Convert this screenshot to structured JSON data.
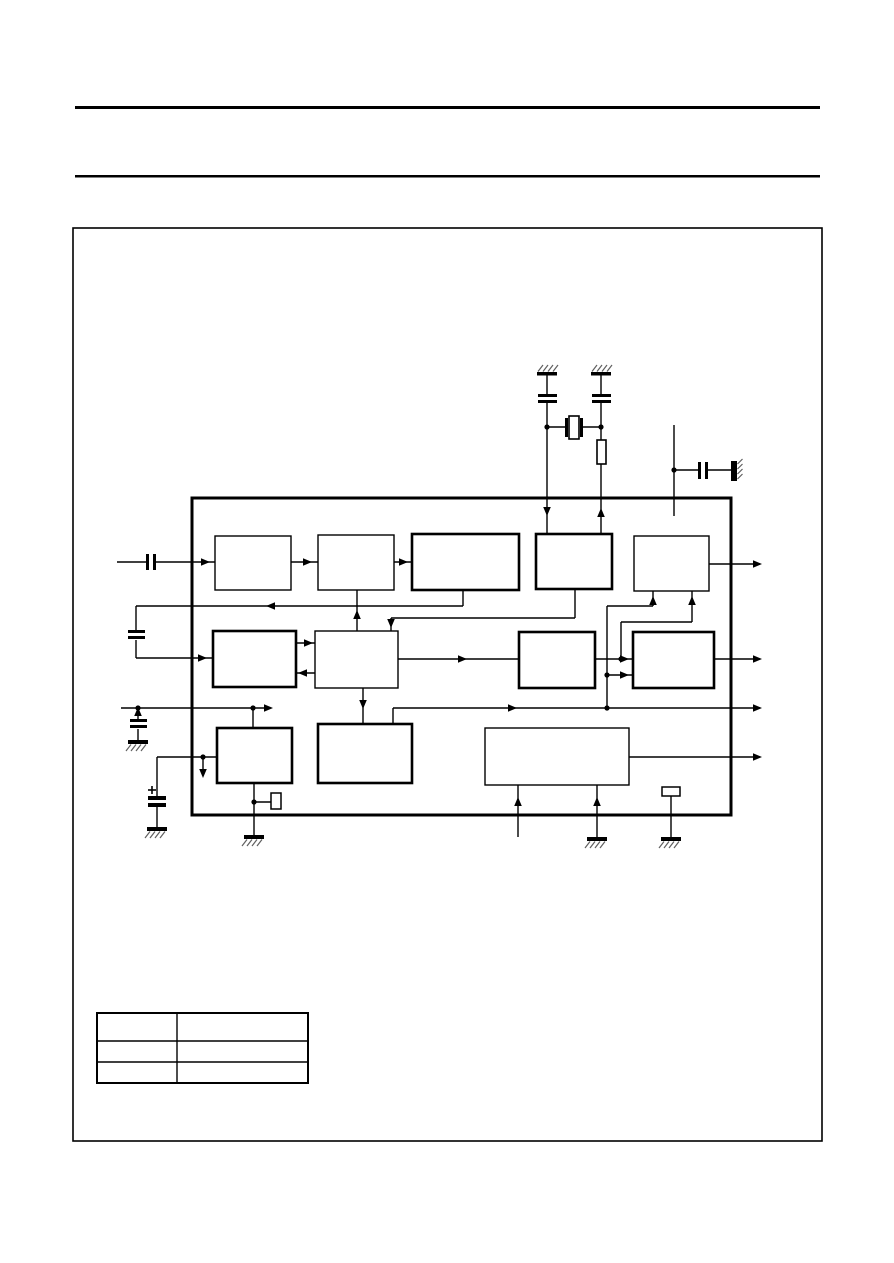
{
  "colors": {
    "ink": "#000000",
    "paper": "#ffffff",
    "hatch": "#606060"
  },
  "header": {
    "rules": [
      {
        "x": 75,
        "y": 106,
        "w": 745,
        "h": 3
      },
      {
        "x": 75,
        "y": 175,
        "w": 745,
        "h": 2.5
      }
    ]
  },
  "figure_frame": {
    "x": 73,
    "y": 228,
    "w": 749,
    "h": 913,
    "stroke": 1.6
  },
  "ic_boundary": {
    "x": 192,
    "y": 498,
    "w": 539,
    "h": 317,
    "stroke": 3
  },
  "blocks": [
    {
      "name": "block-row1-1",
      "x": 215,
      "y": 536,
      "w": 76,
      "h": 54,
      "thick": false
    },
    {
      "name": "block-row1-2",
      "x": 318,
      "y": 535,
      "w": 76,
      "h": 55,
      "thick": false
    },
    {
      "name": "block-row1-3",
      "x": 412,
      "y": 534,
      "w": 107,
      "h": 56,
      "thick": true
    },
    {
      "name": "block-row1-4",
      "x": 536,
      "y": 534,
      "w": 76,
      "h": 55,
      "thick": true
    },
    {
      "name": "block-row1-5",
      "x": 634,
      "y": 536,
      "w": 75,
      "h": 55,
      "thick": false
    },
    {
      "name": "block-row2-1",
      "x": 213,
      "y": 631,
      "w": 83,
      "h": 56,
      "thick": true
    },
    {
      "name": "block-row2-2",
      "x": 315,
      "y": 631,
      "w": 83,
      "h": 57,
      "thick": false
    },
    {
      "name": "block-row2-3",
      "x": 519,
      "y": 632,
      "w": 76,
      "h": 56,
      "thick": true
    },
    {
      "name": "block-row2-4",
      "x": 633,
      "y": 632,
      "w": 81,
      "h": 56,
      "thick": true
    },
    {
      "name": "block-row3-1",
      "x": 217,
      "y": 728,
      "w": 75,
      "h": 55,
      "thick": true
    },
    {
      "name": "block-row3-2",
      "x": 318,
      "y": 724,
      "w": 94,
      "h": 59,
      "thick": true
    },
    {
      "name": "block-row3-3",
      "x": 485,
      "y": 728,
      "w": 144,
      "h": 57,
      "thick": false
    }
  ],
  "wires": [
    [
      547,
      375,
      547,
      394
    ],
    [
      547,
      402,
      547,
      427
    ],
    [
      601,
      375,
      601,
      394
    ],
    [
      601,
      402,
      601,
      427
    ],
    [
      547,
      427,
      566,
      427
    ],
    [
      583,
      427,
      601,
      427
    ],
    [
      547,
      427,
      547,
      534
    ],
    [
      601,
      427,
      601,
      440
    ],
    [
      601,
      464,
      601,
      534
    ],
    [
      674,
      425,
      674,
      516
    ],
    [
      674,
      470,
      698,
      470
    ],
    [
      708,
      470,
      731,
      470
    ],
    [
      117,
      562,
      146,
      562
    ],
    [
      156,
      562,
      215,
      562
    ],
    [
      463,
      590,
      463,
      606
    ],
    [
      136,
      606,
      463,
      606
    ],
    [
      136,
      606,
      136,
      630
    ],
    [
      136,
      640,
      136,
      658
    ],
    [
      136,
      658,
      213,
      658
    ],
    [
      291,
      562,
      318,
      562
    ],
    [
      394,
      562,
      412,
      562
    ],
    [
      357,
      590,
      357,
      631
    ],
    [
      575,
      589,
      575,
      618
    ],
    [
      391,
      618,
      575,
      618
    ],
    [
      391,
      618,
      391,
      631
    ],
    [
      709,
      564,
      760,
      564
    ],
    [
      296,
      643,
      315,
      643
    ],
    [
      296,
      673,
      315,
      673
    ],
    [
      398,
      659,
      519,
      659
    ],
    [
      595,
      659,
      633,
      659
    ],
    [
      621,
      659,
      621,
      622
    ],
    [
      621,
      622,
      692,
      622
    ],
    [
      692,
      622,
      692,
      591
    ],
    [
      607,
      606,
      607,
      707
    ],
    [
      607,
      606,
      653,
      606
    ],
    [
      653,
      606,
      653,
      591
    ],
    [
      607,
      675,
      633,
      675
    ],
    [
      714,
      659,
      760,
      659
    ],
    [
      363,
      688,
      363,
      724
    ],
    [
      121,
      708,
      270,
      708
    ],
    [
      253,
      708,
      253,
      728
    ],
    [
      138,
      708,
      138,
      719
    ],
    [
      138,
      729,
      138,
      740
    ],
    [
      393,
      724,
      393,
      708
    ],
    [
      393,
      708,
      760,
      708
    ],
    [
      157,
      757,
      217,
      757
    ],
    [
      203,
      757,
      203,
      775
    ],
    [
      157,
      757,
      157,
      796
    ],
    [
      157,
      807,
      157,
      827
    ],
    [
      254,
      783,
      254,
      835
    ],
    [
      254,
      802,
      271,
      802
    ],
    [
      518,
      785,
      518,
      837
    ],
    [
      597,
      785,
      597,
      837
    ],
    [
      671,
      796,
      671,
      837
    ],
    [
      629,
      757,
      760,
      757
    ]
  ],
  "arrows": [
    {
      "x": 210,
      "y": 562,
      "dir": "right"
    },
    {
      "x": 312,
      "y": 562,
      "dir": "right"
    },
    {
      "x": 408,
      "y": 562,
      "dir": "right"
    },
    {
      "x": 266,
      "y": 606,
      "dir": "left"
    },
    {
      "x": 357,
      "y": 610,
      "dir": "up"
    },
    {
      "x": 547,
      "y": 516,
      "dir": "down"
    },
    {
      "x": 601,
      "y": 508,
      "dir": "up"
    },
    {
      "x": 391,
      "y": 628,
      "dir": "down"
    },
    {
      "x": 207,
      "y": 658,
      "dir": "right"
    },
    {
      "x": 313,
      "y": 643,
      "dir": "right"
    },
    {
      "x": 298,
      "y": 673,
      "dir": "left"
    },
    {
      "x": 467,
      "y": 659,
      "dir": "right"
    },
    {
      "x": 629,
      "y": 659,
      "dir": "right"
    },
    {
      "x": 629,
      "y": 675,
      "dir": "right"
    },
    {
      "x": 653,
      "y": 596,
      "dir": "up"
    },
    {
      "x": 692,
      "y": 596,
      "dir": "up"
    },
    {
      "x": 762,
      "y": 564,
      "dir": "right"
    },
    {
      "x": 762,
      "y": 659,
      "dir": "right"
    },
    {
      "x": 762,
      "y": 708,
      "dir": "right"
    },
    {
      "x": 762,
      "y": 757,
      "dir": "right"
    },
    {
      "x": 273,
      "y": 708,
      "dir": "right"
    },
    {
      "x": 517,
      "y": 708,
      "dir": "right"
    },
    {
      "x": 363,
      "y": 709,
      "dir": "down"
    },
    {
      "x": 138,
      "y": 707,
      "dir": "up"
    },
    {
      "x": 203,
      "y": 778,
      "dir": "down"
    },
    {
      "x": 518,
      "y": 797,
      "dir": "up"
    },
    {
      "x": 597,
      "y": 797,
      "dir": "up"
    }
  ],
  "junction_dots": [
    [
      547,
      427
    ],
    [
      601,
      427
    ],
    [
      674,
      470
    ],
    [
      621,
      659
    ],
    [
      607,
      675
    ],
    [
      607,
      708
    ],
    [
      253,
      708
    ],
    [
      138,
      708
    ],
    [
      203,
      757
    ],
    [
      254,
      802
    ]
  ],
  "capacitor_plates": [
    {
      "name": "input-coupling-capacitor",
      "rects": [
        [
          146,
          554,
          3,
          16
        ],
        [
          153,
          554,
          3,
          16
        ]
      ]
    },
    {
      "name": "crystal-load-capacitor-1",
      "rects": [
        [
          538,
          394,
          19,
          3
        ],
        [
          538,
          400,
          19,
          3
        ]
      ]
    },
    {
      "name": "crystal-load-capacitor-2",
      "rects": [
        [
          592,
          394,
          19,
          3
        ],
        [
          592,
          400,
          19,
          3
        ]
      ]
    },
    {
      "name": "decoupling-capacitor-right",
      "rects": [
        [
          698,
          462,
          3,
          17
        ],
        [
          705,
          462,
          3,
          17
        ]
      ]
    },
    {
      "name": "feedback-capacitor",
      "rects": [
        [
          128,
          630,
          17,
          3
        ],
        [
          128,
          636,
          17,
          3
        ]
      ]
    },
    {
      "name": "bus-capacitor",
      "rects": [
        [
          130,
          719,
          17,
          3
        ],
        [
          130,
          725,
          17,
          3
        ]
      ]
    },
    {
      "name": "electrolytic-capacitor",
      "rects": [
        [
          148,
          796,
          18,
          4
        ],
        [
          148,
          803,
          18,
          4
        ]
      ],
      "plus_at": [
        152,
        790
      ]
    }
  ],
  "crystal": {
    "plates": [
      [
        565,
        418,
        3,
        19
      ],
      [
        580,
        418,
        3,
        19
      ]
    ],
    "body": {
      "x": 569,
      "y": 416,
      "w": 10,
      "h": 23
    }
  },
  "resistor": {
    "x": 597,
    "y": 440,
    "w": 9,
    "h": 24
  },
  "small_boxes": [
    {
      "name": "internal-resistor-left",
      "x": 271,
      "y": 793,
      "w": 10,
      "h": 16
    },
    {
      "name": "internal-resistor-right",
      "x": 662,
      "y": 787,
      "w": 18,
      "h": 9
    }
  ],
  "grounds_down": [
    [
      138,
      740
    ],
    [
      157,
      827
    ],
    [
      254,
      835
    ],
    [
      597,
      837
    ],
    [
      671,
      837
    ]
  ],
  "grounds_up": [
    [
      547,
      372
    ],
    [
      601,
      372
    ]
  ],
  "ground_wall": {
    "x": 731,
    "y": 461,
    "w": 6,
    "h": 20
  },
  "legend_table": {
    "x": 97,
    "y": 1013,
    "w": 211,
    "h": 70,
    "col_x": 177,
    "row_ys": [
      1041,
      1062
    ],
    "rows": [
      [
        "",
        ""
      ],
      [
        "",
        ""
      ],
      [
        "",
        ""
      ]
    ]
  }
}
